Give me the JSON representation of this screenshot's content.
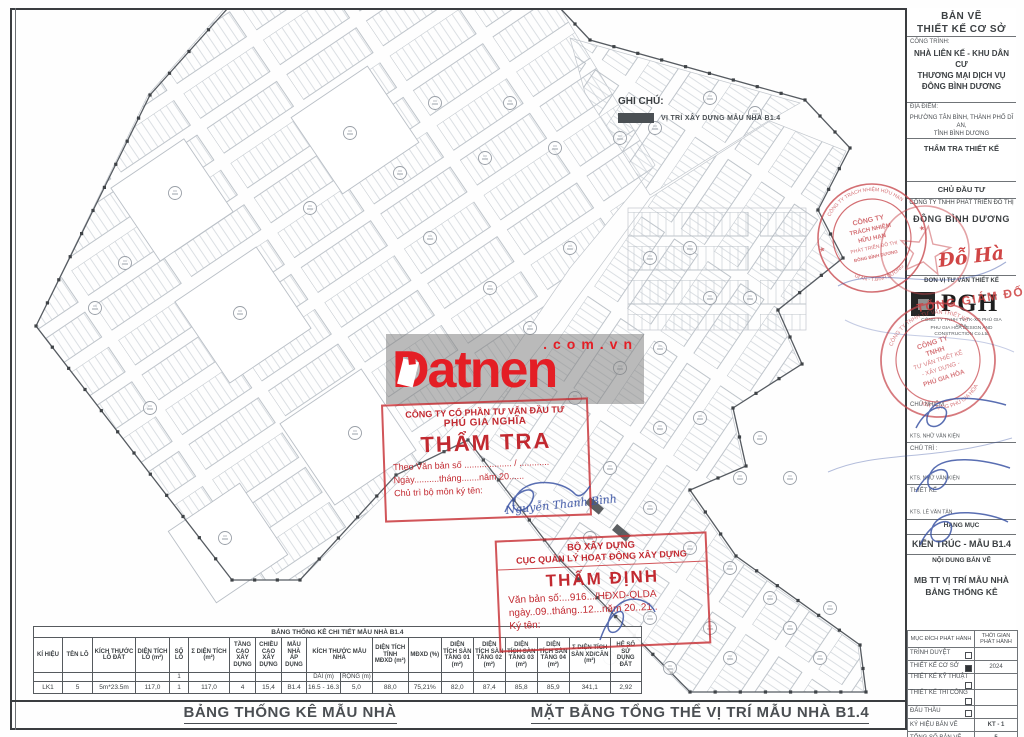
{
  "legend": {
    "title": "GHI CHÚ:",
    "item": "VỊ TRÍ XÂY DỰNG MẪU NHÀ B1.4",
    "swatch_color": "#4b5054"
  },
  "watermark": {
    "brand": "Datnen",
    "suffix": ".com.vn",
    "color": "#e41e25"
  },
  "stamps": {
    "tham_tra": {
      "company_l1": "CÔNG TY CỔ PHẦN TƯ VẤN ĐẦU TƯ",
      "company_l2": "PHÚ GIA NGHĨA",
      "title": "THẨM TRA",
      "line1": "Theo Văn bản số ................... / ............",
      "line2": "Ngày..........tháng.......năm 20......",
      "line3": "Chủ trì bộ môn ký tên:",
      "signer": "Nguyễn Thanh Bình"
    },
    "tham_dinh": {
      "org_l1": "BỘ XÂY DỰNG",
      "org_l2": "CỤC QUẢN LÝ HOẠT ĐỘNG XÂY DỰNG",
      "title": "THẨM ĐỊNH",
      "line1": "Văn bản số:...916.../HĐXD-QLDA",
      "line2": "ngày..09..tháng..12...năm 20..21..",
      "line3": "Ký tên:"
    },
    "round_seal_map": {
      "arc_top": "CÔNG TY TRÁCH NHIỆM HỮU HẠN",
      "c1": "CÔNG TY",
      "c2": "TRÁCH NHIỆM",
      "c3": "HỮU HẠN",
      "c4": "PHÁT TRIỂN ĐÔ THỊ",
      "c5": "ĐÔNG BÌNH DƯƠNG",
      "arc_bottom": "DĨ AN - T.BÌNH DƯƠNG"
    },
    "round_seal_pgh": {
      "arc_top": "CÔNG TY TNHH TƯ VẤN THIẾT KẾ",
      "c1": "CÔNG TY",
      "c2": "TNHH",
      "c3": "TƯ VẤN THIẾT KẾ",
      "c4": "- XÂY DỰNG -",
      "c5": "PHÚ GIA HÒA",
      "arc_bottom": "XÂY DỰNG PHÚ GIA HÒA"
    },
    "red_sign_name": "Đỗ Hà",
    "red_sign_title": "TỔNG GIÁM ĐỐC"
  },
  "sidebar": {
    "sheet_type_l1": "BẢN VẼ",
    "sheet_type_l2": "THIẾT KẾ CƠ SỞ",
    "project_label": "CÔNG TRÌNH:",
    "project_l1": "NHÀ LIÊN KẾ - KHU DÂN CƯ",
    "project_l2": "THƯƠNG MẠI DỊCH VỤ",
    "project_l3": "ĐÔNG BÌNH DƯƠNG",
    "location_label": "ĐỊA ĐIỂM:",
    "location_l1": "PHƯỜNG TÂN BÌNH, THÀNH PHỐ DĨ AN,",
    "location_l2": "TỈNH BÌNH DƯƠNG",
    "review_label": "THẨM TRA THIẾT KẾ",
    "investor_label": "CHỦ ĐẦU TƯ",
    "investor_l1": "CÔNG TY TNHH PHÁT TRIỂN ĐÔ THỊ",
    "investor_l2": "ĐÔNG BÌNH DƯƠNG",
    "consultant_label": "ĐƠN VỊ TƯ VẤN THIẾT KẾ",
    "consultant_logo": "PGH",
    "consultant_l1": "CÔNG TY TNHH TV-TK-XD PHÚ GIA HÒA",
    "consultant_l2": "PHU GIA HOA DESIGN AND CONSTRUCTION Co.Ltd",
    "roles": [
      {
        "label": "CHỦ NHIỆM",
        "name": "KTS. NHỮ VĂN KIỆN"
      },
      {
        "label": "CHỦ TRÌ :",
        "name": "KTS. NHỮ VĂN KIỆN"
      },
      {
        "label": "THIẾT KẾ",
        "name": "KTS. LÊ VĂN TÂN"
      }
    ],
    "category_label": "HẠNG MỤC",
    "category_value": "KIẾN TRÚC - MẪU B1.4",
    "content_label": "NỘI DUNG BẢN VẼ",
    "content_l1": "MB TT VỊ TRÍ MẪU NHÀ",
    "content_l2": "BẢNG THỐNG KÊ",
    "issue_table": {
      "col1": "MỤC ĐÍCH PHÁT HÀNH",
      "col2": "THỜI GIAN PHÁT HÀNH",
      "rows": [
        {
          "label": "TRÌNH DUYỆT",
          "checked": false,
          "value": ""
        },
        {
          "label": "THIẾT KẾ CƠ SỞ",
          "checked": true,
          "value": "2024"
        },
        {
          "label": "THIẾT KẾ KỸ THUẬT",
          "checked": false,
          "value": ""
        },
        {
          "label": "THIẾT KẾ THI CÔNG",
          "checked": false,
          "value": ""
        },
        {
          "label": "ĐẤU THẦU",
          "checked": false,
          "value": ""
        }
      ],
      "code_label": "KÝ HIỆU BẢN VẼ",
      "code_value": "KT - 1",
      "total_label": "TỔNG SỐ BẢN VẼ",
      "total_value": "5"
    }
  },
  "stats_table": {
    "title": "BẢNG THỐNG KÊ CHI TIẾT MẪU NHÀ B1.4",
    "headers": [
      "KÍ HIỆU",
      "TÊN LÔ",
      "KÍCH THƯỚC LÔ ĐẤT",
      "DIỆN TÍCH LÔ (m²)",
      "SỐ LÔ",
      "Σ DIỆN TÍCH (m²)",
      "TẦNG CAO XÂY DỰNG",
      "CHIỀU CAO XÂY DỰNG",
      "MẪU NHÀ ÁP DỤNG",
      "KÍCH THƯỚC MẪU NHÀ",
      "DIỆN TÍCH TÍNH MĐXD (m²)",
      "MĐXD (%)",
      "DIỆN TÍCH SÀN TẦNG 01 (m²)",
      "DIỆN TÍCH SÀN TẦNG 02 (m²)",
      "DIỆN TÍCH SÀN TẦNG 03 (m²)",
      "DIỆN TÍCH SÀN TẦNG 04 (m²)",
      "Σ DIỆN TÍCH SÀN XD/CĂN (m²)",
      "HỆ SỐ SỬ DỤNG ĐẤT"
    ],
    "sub": {
      "count": "1",
      "dai": "DÀI (m)",
      "rong": "RỘNG (m)"
    },
    "row": [
      "LK1",
      "5",
      "5m*23.5m",
      "117,0",
      "1",
      "117,0",
      "4",
      "15,4",
      "B1.4",
      "16.5 - 16.3",
      "5,0",
      "88,0",
      "75,21%",
      "82,0",
      "87,4",
      "85,8",
      "85,9",
      "341,1",
      "2,92"
    ]
  },
  "footer": {
    "left_title": "BẢNG THỐNG KÊ MẪU NHÀ",
    "right_title": "MẶT BẰNG TỔNG THỂ VỊ TRÍ MẪU NHÀ B1.4"
  }
}
